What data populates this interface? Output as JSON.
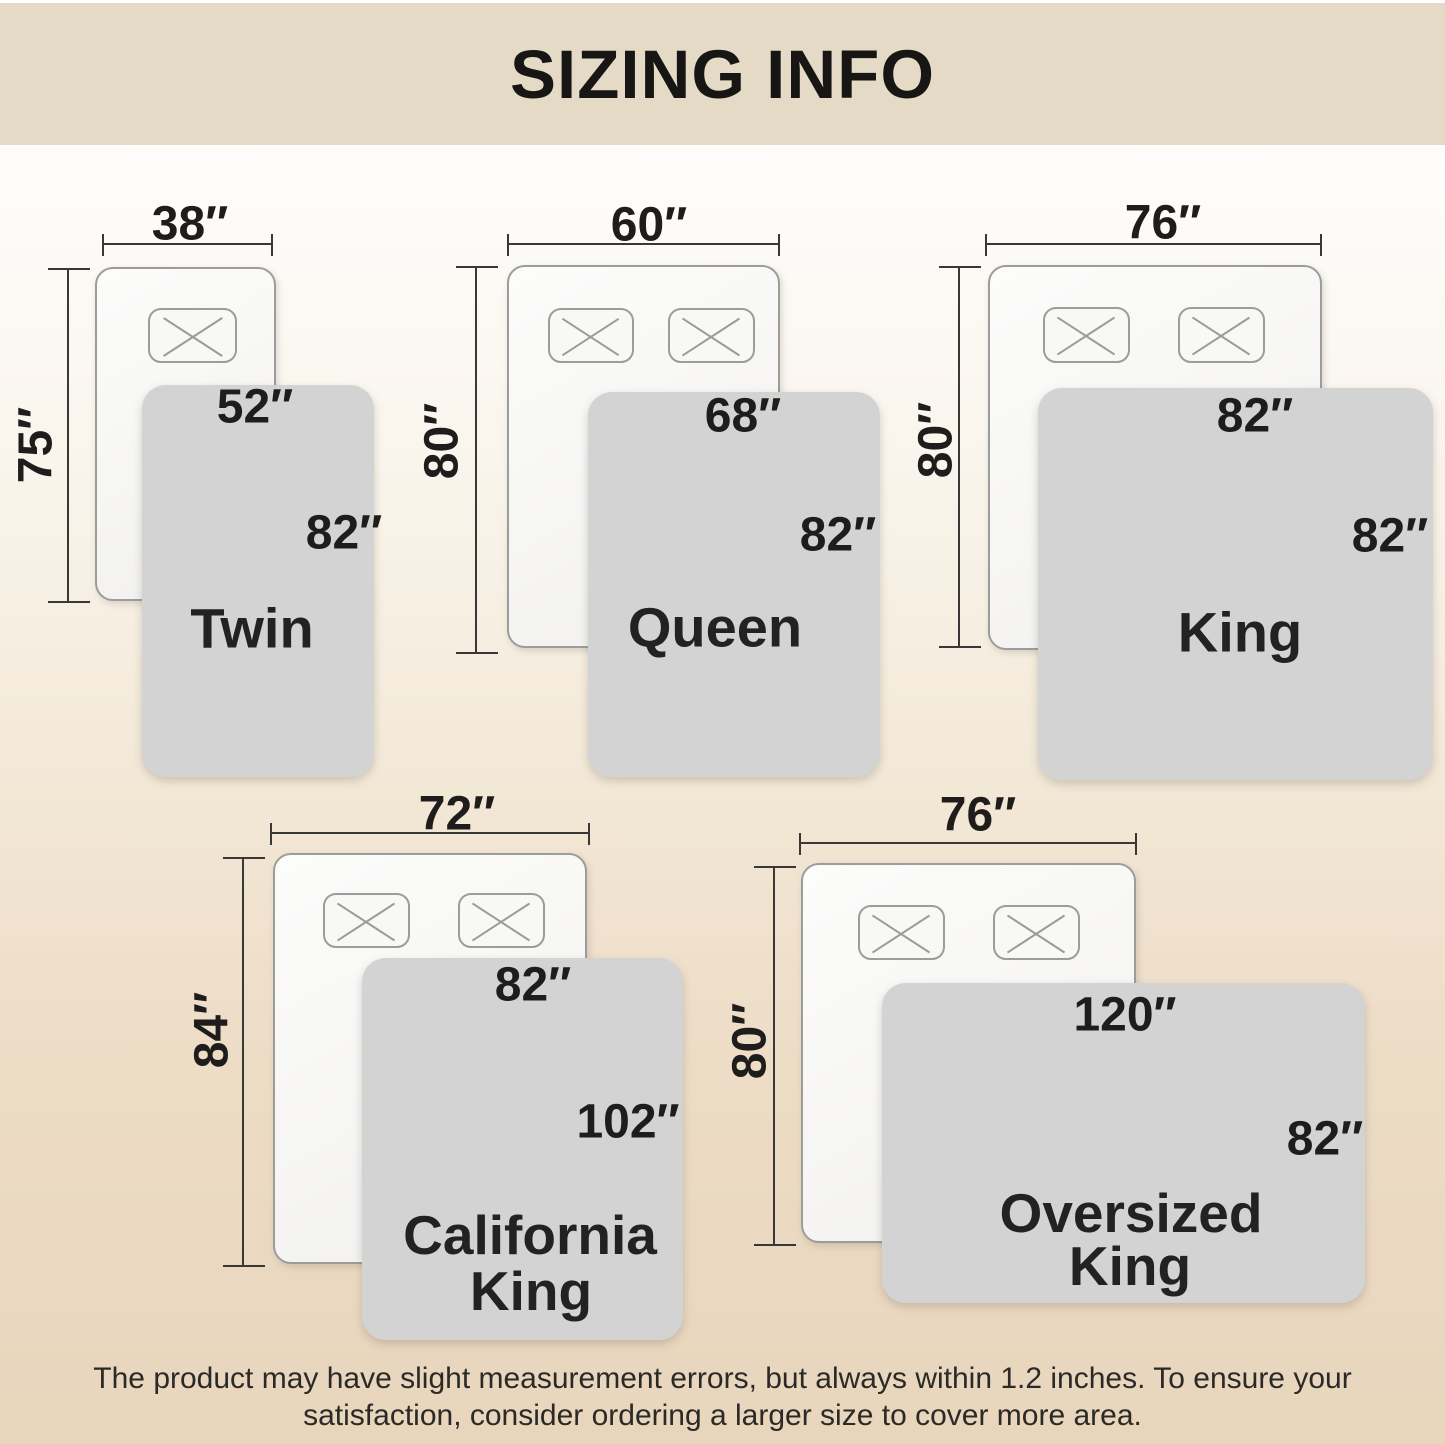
{
  "header": {
    "title": "SIZING INFO"
  },
  "footer": {
    "lines": [
      "The product may have slight measurement errors, but always within 1.2 inches. To ensure your",
      "satisfaction, consider ordering a larger size to cover more area."
    ]
  },
  "colors": {
    "header_background": "#e4dac5",
    "page_background_top": "#ffffff",
    "page_background_bottom": "#e8d5bc",
    "bed_fill": "#f8f8f7",
    "bed_border": "#9c9c9a",
    "blanket_fill": "#d3d3d4",
    "dimension_line": "#3a3836",
    "text": "#1e1d1b"
  },
  "sizes": [
    {
      "id": "twin",
      "name_line1": "Twin",
      "name_line2": "",
      "bed_width": "38″",
      "bed_length": "75″",
      "blanket_width": "52″",
      "blanket_length": "82″",
      "pillow_count": 1
    },
    {
      "id": "queen",
      "name_line1": "Queen",
      "name_line2": "",
      "bed_width": "60″",
      "bed_length": "80″",
      "blanket_width": "68″",
      "blanket_length": "82″",
      "pillow_count": 2
    },
    {
      "id": "king",
      "name_line1": "King",
      "name_line2": "",
      "bed_width": "76″",
      "bed_length": "80″",
      "blanket_width": "82″",
      "blanket_length": "82″",
      "pillow_count": 2
    },
    {
      "id": "california-king",
      "name_line1": "California",
      "name_line2": "King",
      "bed_width": "72″",
      "bed_length": "84″",
      "blanket_width": "82″",
      "blanket_length": "102″",
      "pillow_count": 2
    },
    {
      "id": "oversized-king",
      "name_line1": "Oversized",
      "name_line2": "King",
      "bed_width": "76″",
      "bed_length": "80″",
      "blanket_width": "120″",
      "blanket_length": "82″",
      "pillow_count": 2
    }
  ]
}
